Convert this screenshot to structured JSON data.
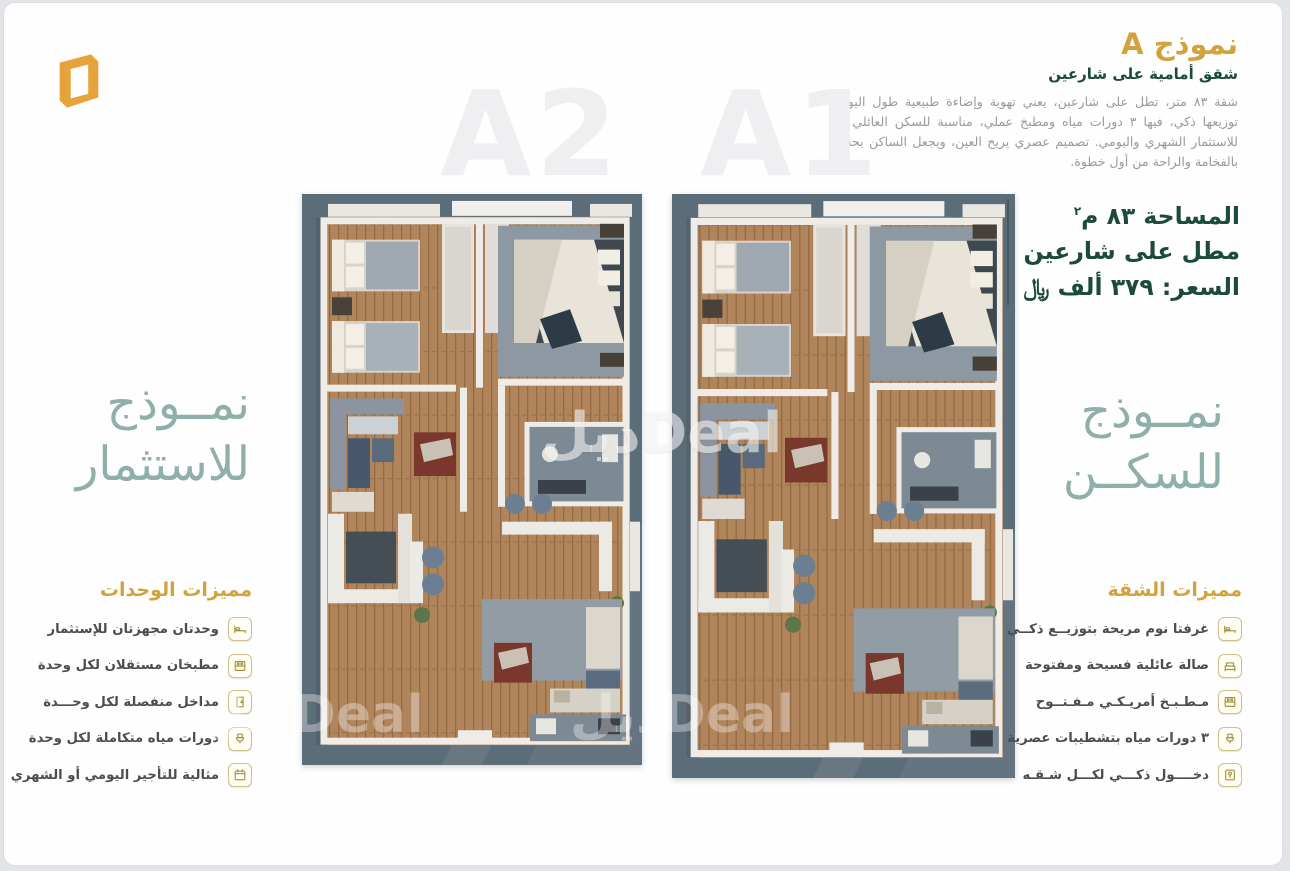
{
  "header": {
    "title": "نموذج A",
    "subtitle": "شقق أمامية على شارعين",
    "description": "شقة ٨٣ متر، تطل على شارعين، يعني تهوية وإضاءة طبيعية طول اليوم. توزيعها ذكي، فيها ٣ دورات مياه ومطبخ عملي، مناسبة للسكن العائلي أو للاستثمار الشهري واليومي. تصميم عصري يريح العين، ويجعل الساكن يحس بالفخامة والراحة من أول خطوة."
  },
  "plans": {
    "left_label": "A2",
    "right_label": "A1"
  },
  "info": {
    "area": "المساحة ٨٣ م",
    "area_sup": "٢",
    "view": "مطل على شارعين",
    "price": "السعر: ٣٧٩ ألف ﷼"
  },
  "slogan_left": {
    "line1": "نمــوذج",
    "line2": "للاستثمار"
  },
  "slogan_right": {
    "line1": "نمــوذج",
    "line2": "للسكــن"
  },
  "features_units": {
    "title": "مميزات الوحدات",
    "items": [
      {
        "icon": "bed-icon",
        "label": "وحدتان مجهزتان للإستثمار"
      },
      {
        "icon": "kitchen-icon",
        "label": "مطبخان مستقلان لكل وحدة"
      },
      {
        "icon": "door-icon",
        "label": "مداخل منفصلة لكل وحـــدة"
      },
      {
        "icon": "bath-icon",
        "label": "دورات مياه متكاملة لكل وحدة"
      },
      {
        "icon": "calendar-icon",
        "label": "مثالية للتأجير اليومي أو الشهري"
      }
    ]
  },
  "features_apartment": {
    "title": "مميزات الشقة",
    "items": [
      {
        "icon": "bed-icon",
        "label": "غرفتا نوم مريحة بتوزيــع ذكــي"
      },
      {
        "icon": "sofa-icon",
        "label": "صالة عائلية فسيحة ومفتوحة"
      },
      {
        "icon": "kitchen-icon",
        "label": "مـطـبـخ أمريـكـي مـفـتــوح"
      },
      {
        "icon": "bath-icon",
        "label": "٣ دورات مياه بتشطيبات عصرية"
      },
      {
        "icon": "smart-entry-icon",
        "label": "دخــــول ذكـــي لكـــل شـقـه"
      }
    ]
  },
  "watermark": {
    "text": "ديلDeal"
  },
  "colors": {
    "gold": "#d2a23d",
    "teal_dark": "#1c4a3e",
    "teal_light": "#8fb0aa",
    "body_text": "#9a9a9a",
    "plan_slate": "#5c6d7a",
    "wood": "#b0855b"
  }
}
